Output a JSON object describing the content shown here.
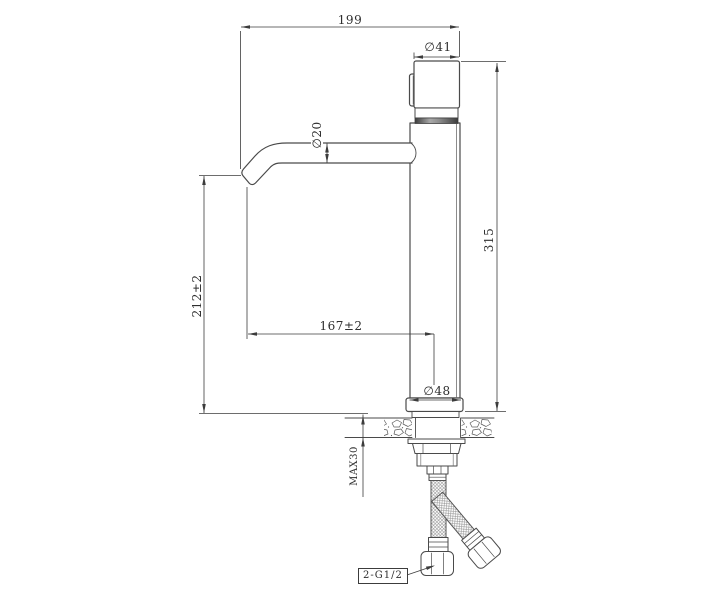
{
  "drawing": {
    "subject": "tall single-lever basin mixer tap, side elevation with installation dimensions",
    "line_color": "#3c3c3c",
    "background": "#ffffff"
  },
  "dims": {
    "overall_width": "199",
    "cap_diameter": "∅41",
    "spout_diameter": "∅20",
    "overall_height": "315",
    "spout_height": "212±2",
    "spout_reach": "167±2",
    "base_diameter": "∅48",
    "max_counter_thickness": "MAX30",
    "hose_connection": "2-G1/2"
  }
}
